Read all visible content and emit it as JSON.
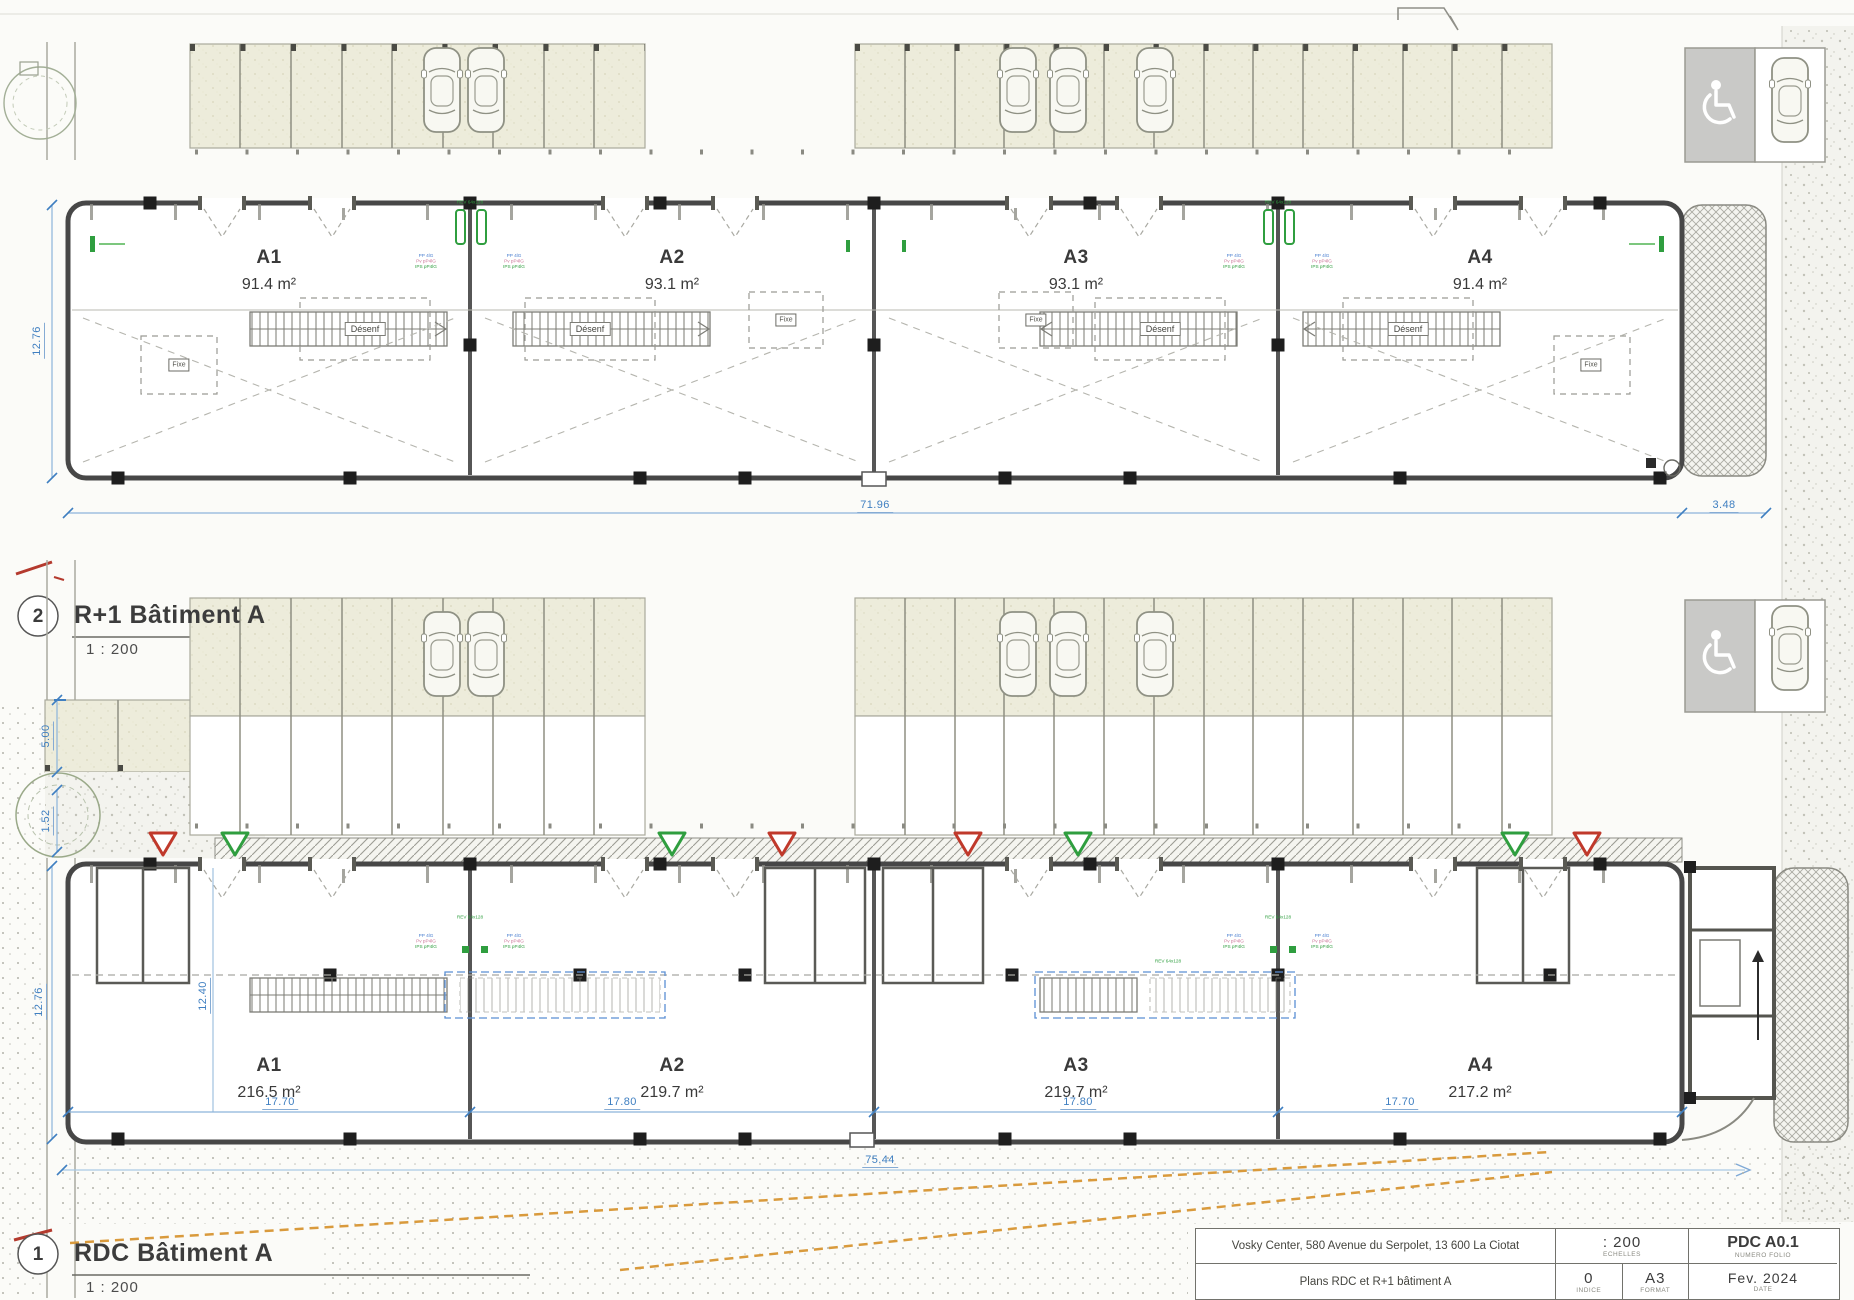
{
  "plans": {
    "r1": {
      "number": "2",
      "title": "R+1 Bâtiment A",
      "scale": "1 : 200",
      "units": [
        {
          "name": "A1",
          "area": "91.4 m²"
        },
        {
          "name": "A2",
          "area": "93.1 m²"
        },
        {
          "name": "A3",
          "area": "93.1 m²"
        },
        {
          "name": "A4",
          "area": "91.4 m²"
        }
      ],
      "dims": {
        "width": "71.96",
        "right": "3.48",
        "height": "12.76"
      },
      "stair_label": "Désenf",
      "fixe_label": "Fixe"
    },
    "rdc": {
      "number": "1",
      "title": "RDC Bâtiment A",
      "scale": "1 : 200",
      "units": [
        {
          "name": "A1",
          "area": "216.5 m²",
          "width": "17.70"
        },
        {
          "name": "A2",
          "area": "219.7 m²",
          "width": "17.80"
        },
        {
          "name": "A3",
          "area": "219.7 m²",
          "width": "17.80"
        },
        {
          "name": "A4",
          "area": "217.2 m²",
          "width": "17.70"
        }
      ],
      "dims": {
        "total": "75.44",
        "height": "12.76",
        "interior": "12.40",
        "stall": "5.00",
        "walk": "1.52"
      }
    }
  },
  "annotations": {
    "door_title": "REV 64x128",
    "door_l1": "PP 4lG",
    "door_l2": "Pv pP4lG",
    "door_l3": "IPS pP4lG"
  },
  "titleblock": {
    "address": "Vosky Center, 580 Avenue du Serpolet, 13 600 La Ciotat",
    "sheet_title": "Plans RDC et R+1 bâtiment A",
    "scale_value": ": 200",
    "scale_label": "ECHELLES",
    "index_value": "0",
    "index_label": "INDICE",
    "format_value": "A3",
    "format_label": "FORMAT",
    "folio_value": "PDC A0.1",
    "folio_label": "NUMERO FOLIO",
    "date_value": "Fev. 2024",
    "date_label": "DATE"
  },
  "colors": {
    "wall": "#474747",
    "dim_blue": "#3f7fc1",
    "green": "#2f9e3f",
    "red": "#c0392b",
    "orange": "#d99a3c",
    "stall_fill": "#edecdb"
  }
}
